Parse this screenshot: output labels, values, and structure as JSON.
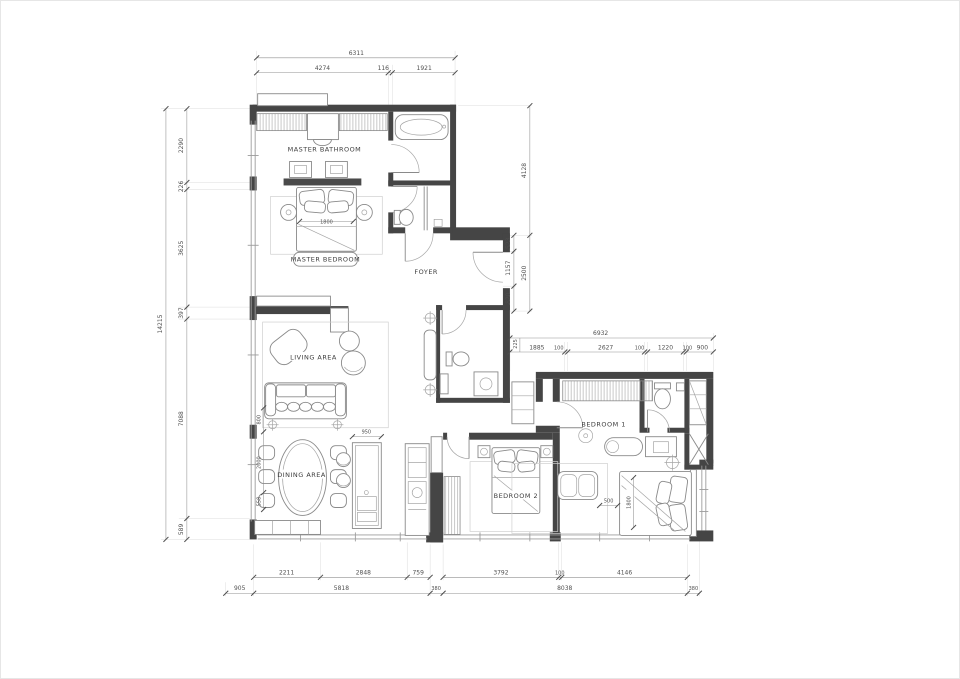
{
  "plan": {
    "rooms": {
      "master_bathroom": "MASTER BATHROOM",
      "master_bedroom": "MASTER BEDROOM",
      "foyer": "FOYER",
      "living_area": "LIVING AREA",
      "dining_area": "DINING AREA",
      "bedroom_1": "BEDROOM 1",
      "bedroom_2": "BEDROOM 2"
    },
    "dims": {
      "top": {
        "total": "6311",
        "segments": [
          "4274",
          "116",
          "1921"
        ]
      },
      "left": {
        "total": "14215",
        "segments": [
          "2290",
          "226",
          "3625",
          "397",
          "7088",
          "589"
        ]
      },
      "right_upper": {
        "outer": [
          "4128",
          "2500"
        ],
        "inner": [
          "523",
          "1157",
          "820"
        ]
      },
      "mid_right": {
        "total": "6932",
        "segments": [
          "1885",
          "100",
          "2627",
          "100",
          "1220",
          "100",
          "900"
        ],
        "side": "225"
      },
      "bottom": {
        "chain": [
          "2211",
          "2848",
          "759",
          "3792",
          "100",
          "4146"
        ],
        "totals": [
          "905",
          "5818",
          "380",
          "8038",
          "380"
        ]
      },
      "interior": {
        "master_bed": "1800",
        "island": "950",
        "bedroom1_gap": "500",
        "bedroom1_bed": "1800",
        "left_chain": [
          "800",
          "2000",
          "558"
        ]
      }
    },
    "colors": {
      "wall": "#454545",
      "furniture_line": "#8a8a8a",
      "dim_line": "#919191",
      "dim_text": "#4f4f4f",
      "background": "#ffffff"
    }
  }
}
